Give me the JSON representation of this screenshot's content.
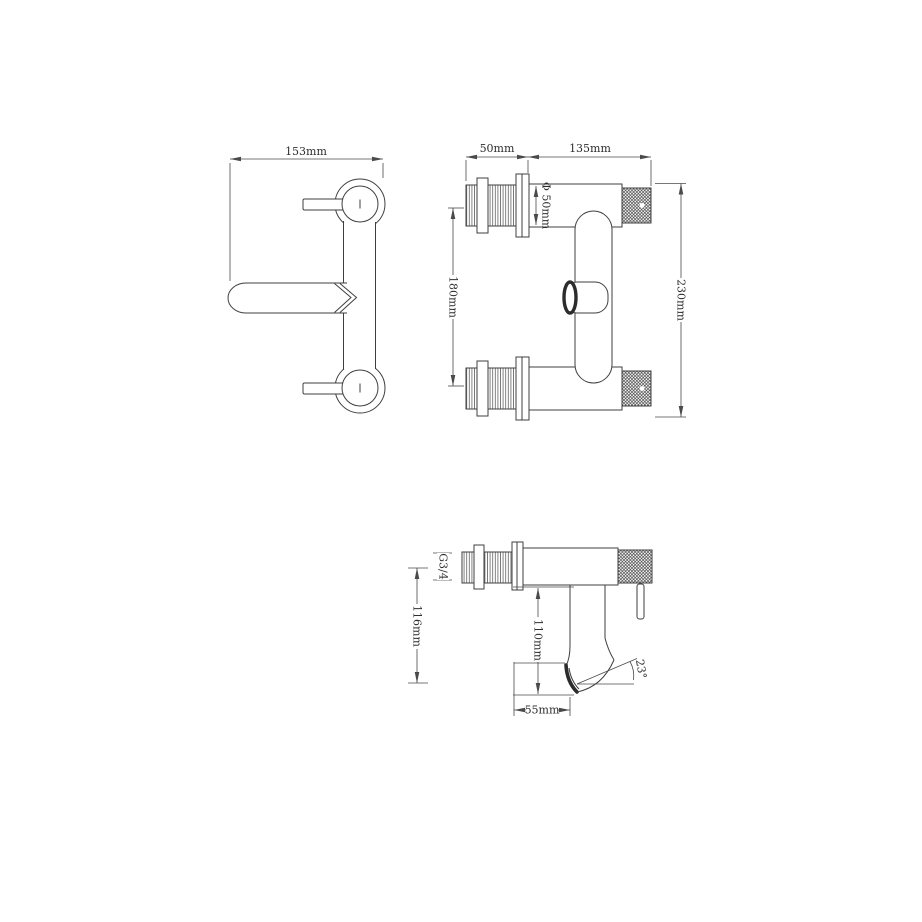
{
  "drawing": {
    "background_color": "#ffffff",
    "line_color": "#3f3f3f",
    "views": {
      "front": {
        "width": "153mm"
      },
      "side": {
        "shank_offset": "50mm",
        "body_length": "135mm",
        "diameter": "Φ 50mm",
        "shank_spacing": "180mm",
        "overall_height": "230mm"
      },
      "profile": {
        "thread": "G3/4",
        "height": "116mm",
        "drop": "110mm",
        "reach": "55mm",
        "angle": "23°"
      }
    }
  }
}
